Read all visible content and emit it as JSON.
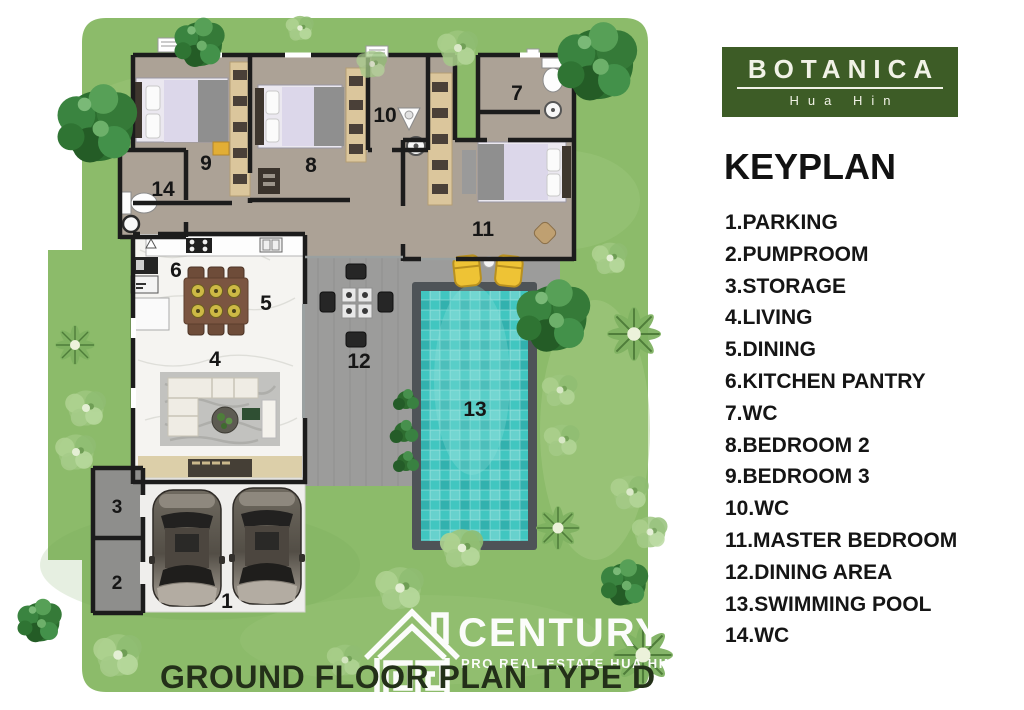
{
  "branding": {
    "name": "BOTANICA",
    "location": "Hua Hin"
  },
  "keyplan": {
    "heading": "KEYPLAN"
  },
  "rooms": [
    {
      "num": "1",
      "name": "PARKING",
      "display": "1.PARKING"
    },
    {
      "num": "2",
      "name": "PUMPROOM",
      "display": "2.PUMPROOM"
    },
    {
      "num": "3",
      "name": "STORAGE",
      "display": "3.STORAGE"
    },
    {
      "num": "4",
      "name": "LIVING",
      "display": "4.LIVING"
    },
    {
      "num": "5",
      "name": "DINING",
      "display": "5.DINING"
    },
    {
      "num": "6",
      "name": "KITCHEN PANTRY",
      "display": "6.KITCHEN PANTRY"
    },
    {
      "num": "7",
      "name": "WC",
      "display": "7.WC"
    },
    {
      "num": "8",
      "name": "BEDROOM 2",
      "display": "8.BEDROOM 2"
    },
    {
      "num": "9",
      "name": "BEDROOM 3",
      "display": "9.BEDROOM 3"
    },
    {
      "num": "10",
      "name": "WC",
      "display": "10.WC"
    },
    {
      "num": "11",
      "name": "MASTER BEDROOM",
      "display": "11.MASTER BEDROOM"
    },
    {
      "num": "12",
      "name": "DINING AREA",
      "display": "12.DINING AREA"
    },
    {
      "num": "13",
      "name": "SWIMMING POOL",
      "display": "13.SWIMMING POOL"
    },
    {
      "num": "14",
      "name": "WC",
      "display": "14.WC"
    }
  ],
  "plan": {
    "title": "GROUND FLOOR PLAN TYPE D"
  },
  "watermark": {
    "brand": "CENTURY",
    "tagline": "PRO REAL ESTATE  HUA HIN"
  },
  "colors": {
    "logo-green": "#3d5c26",
    "lawn": "#8cbb6a",
    "lawn-light": "#a6cc85",
    "lawn-dark": "#74a457",
    "pool-water": "#41c6c0",
    "pool-border": "#4e5357",
    "deck": "#9c9c9b",
    "floor": "#aca296",
    "marble": "#f5f4f1",
    "wall": "#1c1c1c",
    "closet": "#dbc69c",
    "terrace": "#dccfa9",
    "lounger": "#eec335",
    "title": "#233019"
  }
}
